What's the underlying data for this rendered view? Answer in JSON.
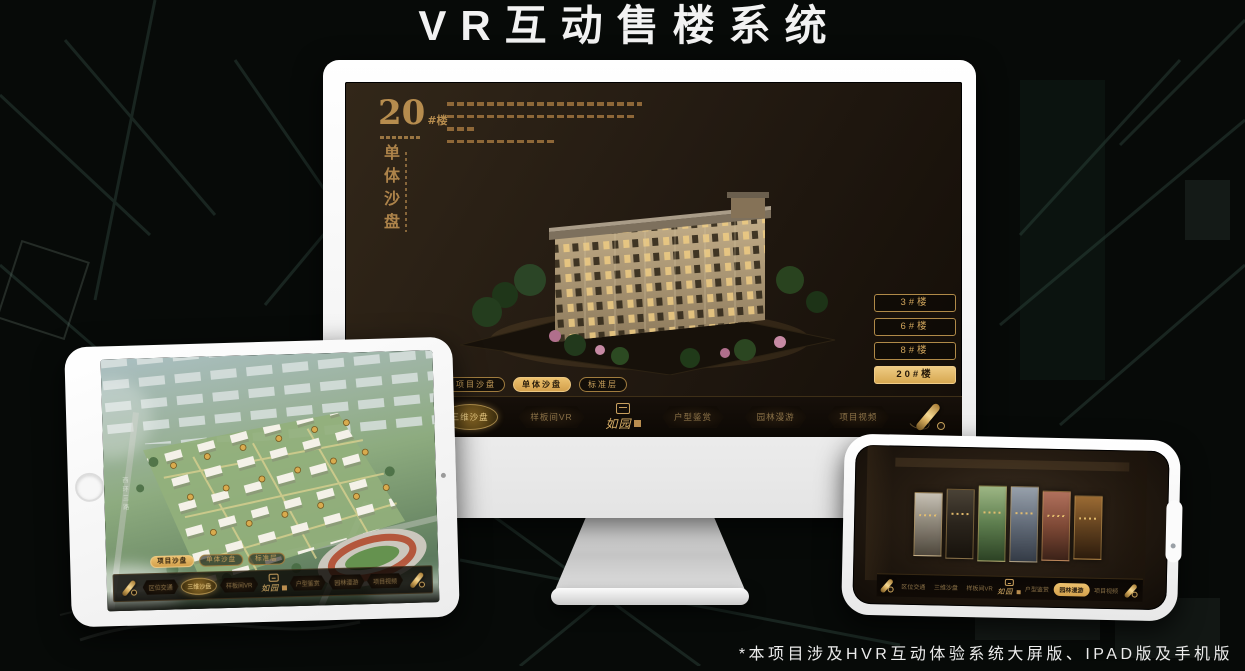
{
  "page": {
    "title": "VR互动售楼系统",
    "footnote": "*本项目涉及HVR互动体验系统大屏版、IPAD版及手机版"
  },
  "colors": {
    "accent_gold": "#c9a05e",
    "selected_gold": "#e0b264",
    "monitor_screen_bg": "#241b12",
    "page_bg": "#070a08",
    "title_text": "#f2f2f2"
  },
  "monitor": {
    "block": {
      "number": "20",
      "suffix": "#楼",
      "vertical_title": "单体沙盘"
    },
    "floor_buttons": [
      {
        "label": "3#楼",
        "selected": false
      },
      {
        "label": "6#楼",
        "selected": false
      },
      {
        "label": "8#楼",
        "selected": false
      },
      {
        "label": "20#楼",
        "selected": true
      }
    ],
    "view_tabs": [
      {
        "label": "项目沙盘",
        "selected": false
      },
      {
        "label": "单体沙盘",
        "selected": true
      },
      {
        "label": "标准层",
        "selected": false
      }
    ],
    "nav": {
      "logo": "如园",
      "items": [
        {
          "label": "区位交通",
          "selected": false
        },
        {
          "label": "三维沙盘",
          "selected": true
        },
        {
          "label": "样板间VR",
          "selected": false
        },
        {
          "label": "户型鉴赏",
          "selected": false
        },
        {
          "label": "园林漫游",
          "selected": false
        },
        {
          "label": "项目视频",
          "selected": false
        }
      ]
    }
  },
  "ipad": {
    "road_label": "西环三路",
    "view_tabs": [
      {
        "label": "项目沙盘",
        "selected": true
      },
      {
        "label": "单体沙盘",
        "selected": false
      },
      {
        "label": "标准层",
        "selected": false
      }
    ],
    "nav": {
      "logo": "如园",
      "items": [
        {
          "label": "区位交通",
          "selected": false
        },
        {
          "label": "三维沙盘",
          "selected": true
        },
        {
          "label": "样板间VR",
          "selected": false
        },
        {
          "label": "户型鉴赏",
          "selected": false
        },
        {
          "label": "园林漫游",
          "selected": false
        },
        {
          "label": "项目视频",
          "selected": false
        }
      ]
    }
  },
  "phone": {
    "nav": {
      "logo": "如园",
      "items": [
        {
          "label": "区位交通",
          "selected": false
        },
        {
          "label": "三维沙盘",
          "selected": false
        },
        {
          "label": "样板间VR",
          "selected": false
        },
        {
          "label": "户型鉴赏",
          "selected": false
        },
        {
          "label": "园林漫游",
          "selected": true
        },
        {
          "label": "项目视频",
          "selected": false
        }
      ]
    }
  }
}
